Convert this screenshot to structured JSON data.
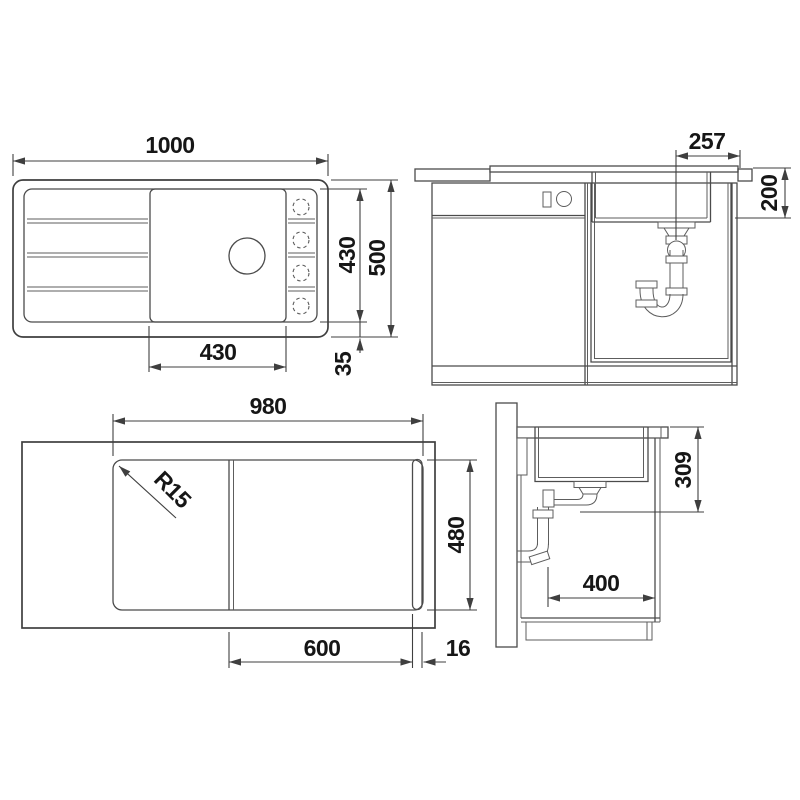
{
  "drawing_type": "sink installation dimension drawing",
  "colors": {
    "background": "#ffffff",
    "line": "#4b4b4b",
    "dimension_text": "#161616"
  },
  "views": {
    "plan": {
      "dims": {
        "overall_width": "1000",
        "basin_zone_height": "430",
        "overall_height": "500",
        "bowl_width": "430",
        "edge_margin": "35"
      }
    },
    "front_section": {
      "dims": {
        "drain_to_right_edge": "257",
        "bowl_depth": "200"
      }
    },
    "cutout_plan": {
      "dims": {
        "cutout_width": "980",
        "corner_radius": "R15",
        "cutout_height": "480",
        "bowl_section_width": "600",
        "strip_width": "16"
      }
    },
    "side_section": {
      "dims": {
        "installation_depth": "309",
        "clearance_width": "400"
      }
    }
  }
}
